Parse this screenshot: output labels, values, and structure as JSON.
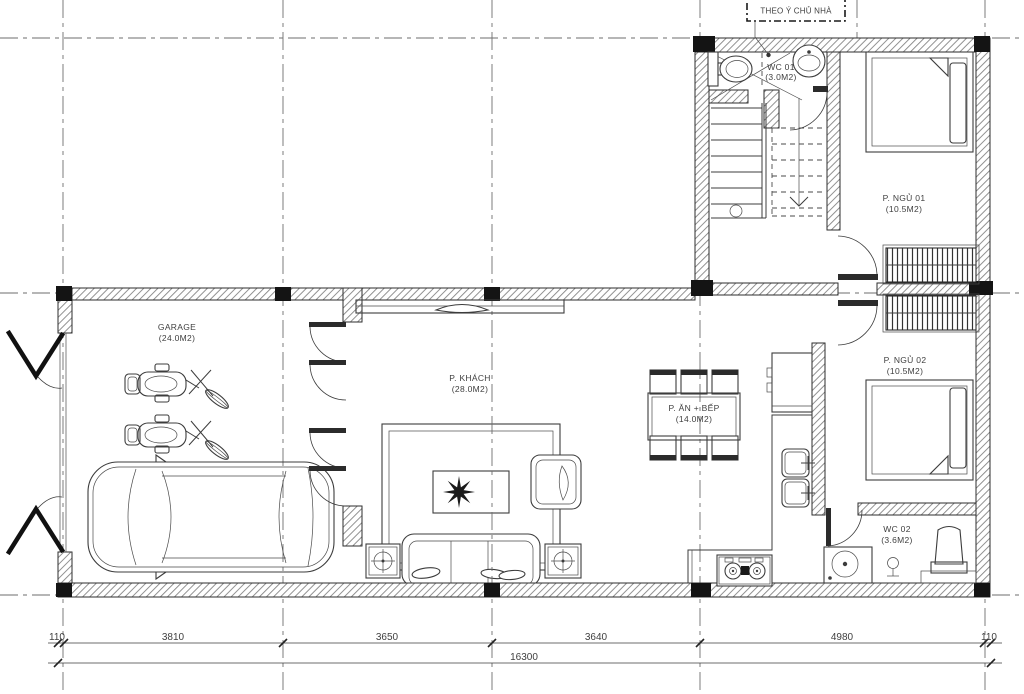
{
  "annotation_box": {
    "label": "THEO Ý CHỦ NHÀ"
  },
  "rooms": {
    "wc1": {
      "name": "WC 01",
      "area": "(3.0M2)"
    },
    "bedroom1": {
      "name": "P. NGỦ 01",
      "area": "(10.5M2)"
    },
    "garage": {
      "name": "GARAGE",
      "area": "(24.0M2)"
    },
    "living": {
      "name": "P. KHÁCH",
      "area": "(28.0M2)"
    },
    "dining": {
      "name": "P. ĂN + BẾP",
      "area": "(14.0M2)"
    },
    "bedroom2": {
      "name": "P. NGỦ 02",
      "area": "(10.5M2)"
    },
    "wc2": {
      "name": "WC 02",
      "area": "(3.6M2)"
    }
  },
  "dimensions": {
    "segments": [
      "110",
      "3810",
      "3650",
      "3640",
      "4980",
      "110"
    ],
    "total": "16300"
  },
  "colors": {
    "line": "#3c3c3c",
    "wall_hatch": "#808080",
    "column": "#141414",
    "background": "#ffffff"
  }
}
